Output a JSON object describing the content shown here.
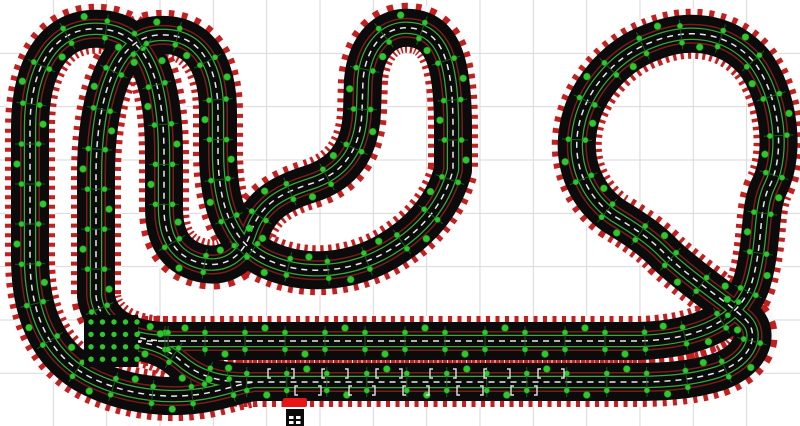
{
  "app": {
    "view_title": "slot-car-track-layout"
  },
  "canvas": {
    "width": 800,
    "height": 426,
    "background_color": "#ffffff"
  },
  "grid": {
    "spacing": 53.33,
    "color": "#d9d9d9",
    "line_width": 1,
    "columns": 15,
    "rows": 8
  },
  "track": {
    "surface_color": "#0b0b0b",
    "curb_white": "#f7f7f7",
    "curb_red": "#c12020",
    "curb_width": 50,
    "curb_dash": "4 5.5",
    "tarmac_width": 38,
    "lane_outer_color": "#7a1b1b",
    "lane_inner_color": "#3aa63a",
    "center_dash_color": "#e9e9e9",
    "center_dash": "6 5",
    "layers": [
      {
        "name": "curb-white",
        "stroke": "#f7f7f7",
        "width": 50
      },
      {
        "name": "curb-red",
        "stroke": "#c12020",
        "width": 50,
        "dash": "4 5.5"
      },
      {
        "name": "tarmac",
        "stroke": "#0b0b0b",
        "width": 38
      },
      {
        "name": "lane-outer-band",
        "stroke": "#7a1b1b",
        "width": 20
      },
      {
        "name": "lane-outer-mask",
        "stroke": "#0b0b0b",
        "width": 17
      },
      {
        "name": "lane-inner-band",
        "stroke": "#3aa63a",
        "width": 12.5
      },
      {
        "name": "lane-inner-mask",
        "stroke": "#0b0b0b",
        "width": 10
      },
      {
        "name": "center-line",
        "stroke": "#e9e9e9",
        "width": 1.5,
        "dash": "6 5"
      }
    ],
    "paths": {
      "main_circuit": "M 125 341 L 640 341 C 700 339 740 320 752 282 C 764 240 758 208 770 185 C 786 152 779 95 754 62 C 726 30 686 28 652 42 C 614 56 584 92 578 130 C 572 166 588 198 614 216 C 634 228 652 240 666 255 C 696 283 728 302 746 320 C 760 334 752 360 718 372 C 690 381 660 382 632 382 L 245 382 C 215 382 196 374 180 360 C 166 348 148 341 125 341 Z",
      "left_loop": "M 168 341 C 128 341 99 324 96 296 L 96 175 C 96 108 112 38 158 35 C 204 32 218 72 218 112 L 218 152 C 218 204 232 244 268 260 C 306 277 352 272 388 251 C 422 231 444 204 453 170 L 453 128 C 453 72 446 36 417 29 C 386 22 366 46 363 80 L 362 112 C 360 152 342 174 310 184 C 278 194 260 206 251 232 C 243 257 224 269 200 263 C 174 256 164 236 164 208 L 164 155 C 164 82 148 33 102 29 C 52 25 30 70 30 128 L 30 258 C 30 310 46 353 88 376 C 128 397 176 400 212 392 C 230 388 240 384 254 382"
    },
    "joints": {
      "spacing": 40,
      "dot_color": "#2ec82e",
      "dot_edge_color": "#1f8f1f",
      "dot_radius": 2.7,
      "lane_offset": 8.5,
      "cross_color": "#1d5a1d",
      "cross_half_length": 15,
      "mid_dot_radius": 3.4,
      "mid_dot_offset": 13
    }
  },
  "crossing_pad": {
    "x": 84,
    "y": 315,
    "width": 54,
    "height": 52,
    "fill": "#0b0b0b",
    "dot_color": "#2ec82e",
    "dot_radius": 2.7,
    "dot_cols": 5,
    "dot_rows": 4,
    "dot_x0": 91,
    "dot_dx": 11.5,
    "dot_y0": 322,
    "dot_dy": 12.4
  },
  "start_grid": {
    "bracket_color": "#e0e0e0",
    "bracket_height": 9,
    "bracket_arm": 3,
    "bracket_line_width": 1.4,
    "pair_gap": 26,
    "rows": [
      {
        "y": 369,
        "pair_starts": [
          268,
          322,
          376,
          430,
          484,
          538
        ]
      },
      {
        "y": 386,
        "pair_starts": [
          295,
          349,
          403,
          457,
          511
        ]
      }
    ]
  },
  "power_base": {
    "connector_color": "#e81515",
    "connector": {
      "x": 283,
      "y": 398,
      "width": 24,
      "height": 9,
      "rx": 2
    },
    "body_color": "#0b0b0b",
    "body": {
      "x": 286,
      "y": 409,
      "width": 18,
      "height": 17
    },
    "socket_color": "#ffffff",
    "sockets": [
      {
        "x": 289,
        "y": 416,
        "width": 4.5,
        "height": 3
      },
      {
        "x": 296,
        "y": 416,
        "width": 4.5,
        "height": 3
      },
      {
        "x": 289,
        "y": 421,
        "width": 4.5,
        "height": 3
      },
      {
        "x": 296,
        "y": 421,
        "width": 4.5,
        "height": 3
      }
    ]
  }
}
